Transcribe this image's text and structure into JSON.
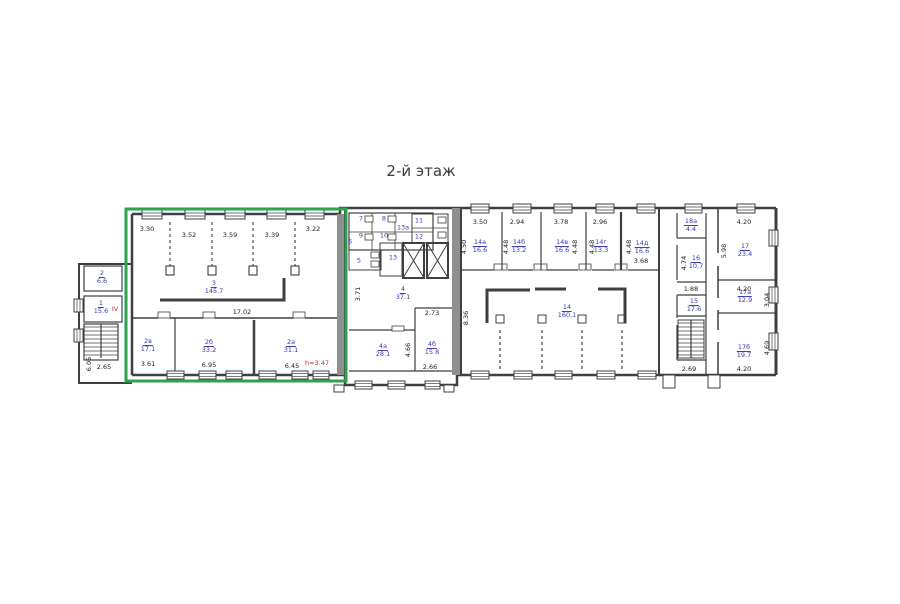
{
  "title": "2-й этаж",
  "colors": {
    "highlight_green": "#2ea24e",
    "room_label_blue": "#3a3ab2",
    "annotation_red": "#c03030",
    "wall_gray": "#3f3f3f"
  },
  "rooms": {
    "r1": {
      "num": "1",
      "area": "15.6"
    },
    "r2": {
      "num": "2",
      "area": "6.6"
    },
    "r3": {
      "num": "3",
      "area": "145.7"
    },
    "r2a": {
      "num": "2а",
      "area": "31.1"
    },
    "r2b": {
      "num": "2б",
      "area": "33.2"
    },
    "r2v": {
      "num": "2в",
      "area": "17.1"
    },
    "r4": {
      "num": "4",
      "area": "37.1"
    },
    "r4a": {
      "num": "4а",
      "area": "28.1"
    },
    "r4b": {
      "num": "4б",
      "area": "15.8"
    },
    "r5": {
      "num": "5"
    },
    "r6": {
      "num": "6"
    },
    "r7": {
      "num": "7"
    },
    "r8": {
      "num": "8"
    },
    "r9": {
      "num": "9"
    },
    "r10": {
      "num": "10"
    },
    "r11": {
      "num": "11"
    },
    "r12": {
      "num": "12"
    },
    "r13": {
      "num": "13"
    },
    "r13a": {
      "num": "13а"
    },
    "r14": {
      "num": "14",
      "area": "160.1"
    },
    "r14a": {
      "num": "14а",
      "area": "16.6"
    },
    "r14b": {
      "num": "14б",
      "area": "13.2"
    },
    "r14v": {
      "num": "14в",
      "area": "16.6"
    },
    "r14g": {
      "num": "14г",
      "area": "13.3"
    },
    "r14d": {
      "num": "14д",
      "area": "16.6"
    },
    "r15": {
      "num": "15",
      "area": "17.6"
    },
    "r16": {
      "num": "16",
      "area": "10.7"
    },
    "r17": {
      "num": "17",
      "area": "23.4"
    },
    "r17a": {
      "num": "17а",
      "area": "12.9"
    },
    "r17b": {
      "num": "17б",
      "area": "19.7"
    },
    "r18a": {
      "num": "18а",
      "area": "4.4"
    }
  },
  "dims": {
    "top_w1": "3.30",
    "top_w2": "3.52",
    "top_w3": "3.59",
    "top_w4": "3.39",
    "top_w5": "3.22",
    "room3_width": "17.02",
    "w2v": "3.61",
    "w2b": "6.95",
    "w2a": "6.45",
    "wing_h": "6.05",
    "wing_w": "2.65",
    "corr": "3.71",
    "r4b_top": "2.73",
    "r4a_h": "4.66",
    "r4b_bot": "2.66",
    "hall_h": "8.36",
    "rt_w1": "3.50",
    "rt_w2": "2.94",
    "rt_w3": "3.78",
    "rt_w4": "2.96",
    "v14a": "4.50",
    "v14b": "4.48",
    "v14v": "4.48",
    "v14g": "4.48",
    "v14d": "4.48",
    "r14d_w": "3.68",
    "r16_h": "4.74",
    "lobby": "1.88",
    "stair_w": "2.69",
    "r17_w": "4.20",
    "r17_h": "5.98",
    "r17a_w": "4.20",
    "r17a_h": "3.04",
    "r17b_h": "4.69",
    "r17b_w": "4.20"
  },
  "annotations": {
    "section": "IV",
    "height_note": "h=3.47"
  }
}
